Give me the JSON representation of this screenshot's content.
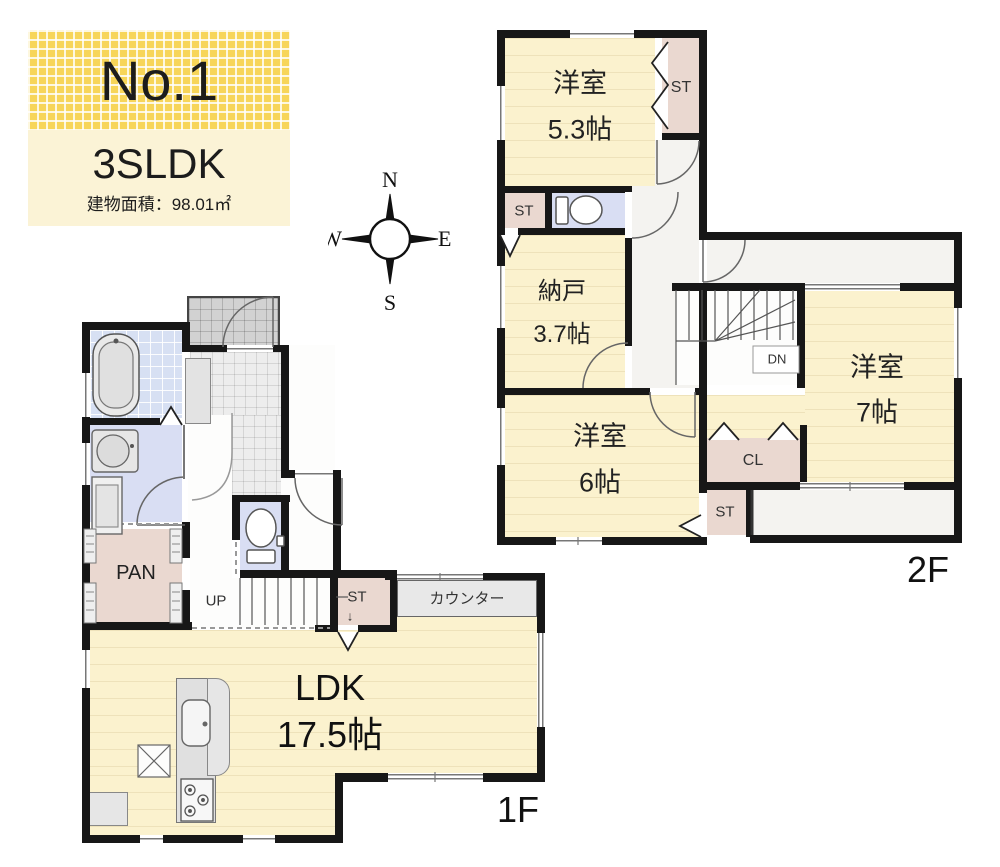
{
  "title": {
    "number": "No.1",
    "layout": "3SLDK",
    "area_label": "建物面積：98.01㎡"
  },
  "compass": {
    "north": "N",
    "east": "E",
    "south": "S",
    "west": "W"
  },
  "floor2": {
    "floor_label": "2F",
    "bedroom_53": {
      "name": "洋室",
      "size": "5.3帖"
    },
    "storage_top": "ST",
    "storage_mid": "ST",
    "closet_nando": {
      "name": "納戸",
      "size": "3.7帖"
    },
    "bedroom_7": {
      "name": "洋室",
      "size": "7帖"
    },
    "closet_cl": "CL",
    "bedroom_6": {
      "name": "洋室",
      "size": "6帖"
    },
    "storage_bottom": "ST",
    "stairs_down": "DN"
  },
  "floor1": {
    "floor_label": "1F",
    "ldk": {
      "name": "LDK",
      "size": "17.5帖"
    },
    "pantry": "PAN",
    "stairs_up": "UP",
    "storage": "ST",
    "storage_arrow": "↓",
    "counter": "カウンター"
  },
  "palette": {
    "wall": "#171717",
    "room_cream": "#FBF2CE",
    "closet_pink": "#EAD8D0",
    "wet_area_blue": "#D9DEF3",
    "accent_yellow": "#F7D558"
  }
}
